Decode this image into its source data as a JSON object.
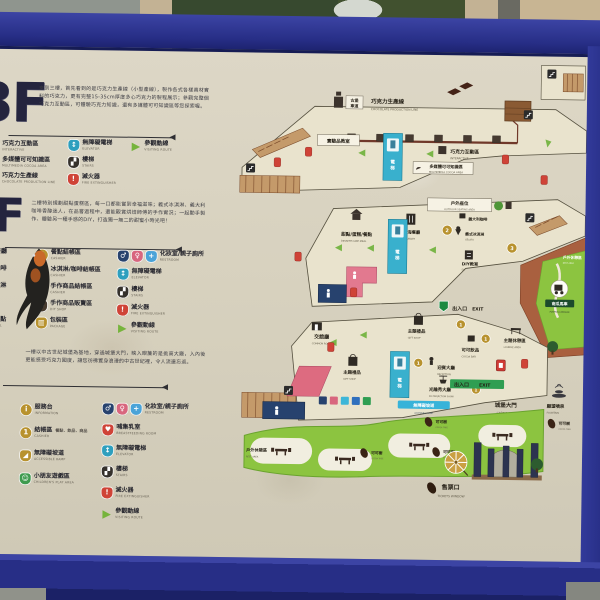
{
  "photo": {
    "scene": "outdoor map signboard of a chocolate castle park",
    "colors": {
      "frame": "#2c3494",
      "sign": "#d8d2c1",
      "lawn": "#8cc440",
      "terrace": "#a9603f",
      "elevator": "#39b0cd",
      "route_arrow": "#7ab648",
      "fire": "#cf4337",
      "restroom_f": "#d8667e",
      "restroom_m": "#27426e",
      "cashier_badge": "#b8922e",
      "exit_green": "#2f9e52"
    }
  },
  "icons": {
    "elevator": "↕",
    "stairs": "▞",
    "fire": "!",
    "route": "▶",
    "info": "i",
    "male": "♂",
    "female": "♀",
    "family": "+",
    "ramp": "◢",
    "shop": "✂",
    "package": "▥",
    "heart": "♥",
    "play": "☺"
  },
  "floors": [
    {
      "big": "3F",
      "intro": "來到三樓，首先看到的是巧克力生產線（小型產線），製作各式各樣真材實料的巧克力，更有完整15-35cm厚度多心巧克力的製程展示；參觀完整個巧克力互動區，可體驗巧克力知識，還有多媒體可可知識區等您探索喔。",
      "legend_left": [
        {
          "zh": "巧克力互動區",
          "en": "INTERACTIVE"
        },
        {
          "zh": "多媒體可可知識區",
          "en": "MULTIMEDIA COCOA AREA"
        },
        {
          "zh": "巧克力生產線",
          "en": "CHOCOLATE PRODUCTION LINE"
        }
      ],
      "legend_mid": [
        {
          "zh": "無障礙電梯",
          "en": "ELEVATOR"
        },
        {
          "zh": "樓梯",
          "en": "STAIRS"
        },
        {
          "zh": "滅火器",
          "en": "FIRE EXTINGUISHER"
        }
      ],
      "legend_right": [
        {
          "zh": "參觀動線",
          "en": "VISITING ROUTE"
        }
      ]
    },
    {
      "big": "2F",
      "intro": "二樓特別規劃甜點蛋糕區，每一口都能嘗到幸福滋味；義式冰淇淋、義大利咖啡香醇迷人，在品嘗過程中，還能觀賞烘焙師傅的手作實況；一起動手製作、體驗另一種手感的DIY，打造獨一無二的甜蜜小時光吧！",
      "legend_left": [
        {
          "zh": "地中海餐廳",
          "en": "RESTAURANT"
        },
        {
          "zh": "義大利咖啡",
          "en": "COFFEE"
        },
        {
          "zh": "義式冰淇淋",
          "en": "GELATO"
        },
        {
          "zh": "DIY教室",
          "en": "DIY ROOM"
        },
        {
          "zh": "甜點/蛋糕/餐點",
          "en": "DESSERT·CAKE·MEAL"
        }
      ],
      "legend_mid": [
        {
          "badge": "1",
          "zh": "餐點結帳區",
          "en": "CASHIER"
        },
        {
          "badge": "2",
          "zh": "冰淇淋/咖啡結帳區",
          "en": "CASHIER"
        },
        {
          "badge": "3",
          "zh": "手作商品結帳區",
          "en": "CASHIER"
        },
        {
          "zh": "手作商品販賣區",
          "en": "DIY SHOP"
        },
        {
          "zh": "包裝區",
          "en": "PACKAGE"
        }
      ],
      "legend_right": [
        {
          "zh": "化妝室/親子廁所",
          "en": "RESTROOM"
        },
        {
          "zh": "無障礙電梯",
          "en": "ELEVATOR"
        },
        {
          "zh": "樓梯",
          "en": "STAIRS"
        },
        {
          "zh": "滅火器",
          "en": "FIRE EXTINGUISHER"
        },
        {
          "zh": "參觀動線",
          "en": "VISITING ROUTE"
        }
      ]
    },
    {
      "big": "1F",
      "intro": "一樓以中古世紀城堡為基地，穿過城堡大門，映入眼簾的是挑高大廳，入內後更能感受巧克力國度，讓您彷彿置身浪漫的中古世紀裡，令人流連忘返。",
      "legend_left": [
        {
          "zh": "服務台",
          "en": "INFORMATION"
        },
        {
          "zh": "結帳區",
          "en": "CASHIER",
          "note": "餐點．飲品．商品"
        },
        {
          "zh": "無障礙坡道",
          "en": "ACCESSIBLE RAMP"
        },
        {
          "zh": "小朋友遊戲區",
          "en": "CHILDREN'S PLAY AREA"
        }
      ],
      "legend_right": [
        {
          "zh": "化妝室/親子廁所",
          "en": "RESTROOM"
        },
        {
          "zh": "哺集乳室",
          "en": "BREASTFEEDING ROOM"
        },
        {
          "zh": "無障礙電梯",
          "en": "ELEVATOR"
        },
        {
          "zh": "樓梯",
          "en": "STAIRS"
        },
        {
          "zh": "滅火器",
          "en": "FIRE EXTINGUISHER"
        },
        {
          "zh": "參觀動線",
          "en": "VISITING ROUTE"
        }
      ]
    }
  ],
  "map": {
    "prod_tag": {
      "c1": "古堡",
      "c2": "車道"
    },
    "prodline": {
      "zh": "巧克力生產線",
      "en": "CHOCOLATE PRODUCTION LINE"
    },
    "lab": {
      "zh": "實驗品教室"
    },
    "interactive": {
      "zh": "巧克力互動區",
      "en": "INTERACTIVE"
    },
    "multimedia": {
      "zh": "多媒體可可知識區",
      "en": "MULTIMEDIA COCOA AREA"
    },
    "elevator": {
      "c1": "電",
      "c2": "梯"
    },
    "outdoor_seating": {
      "zh": "戶外座位",
      "en": "OUTDOOR SEATING AREA"
    },
    "dessert": {
      "zh": "甜點/蛋糕/餐點",
      "en": "DESSERT·CAKE·MEAL"
    },
    "restaurant": {
      "zh": "地中海餐廳",
      "en": "RESTAURANT"
    },
    "coffee": {
      "zh": "義大利咖啡"
    },
    "gelato": {
      "zh": "義式冰淇淋",
      "en": "GELATO"
    },
    "diy": {
      "zh": "DIY教室",
      "en": "DIY"
    },
    "exit": {
      "zh": "出入口",
      "en": "EXIT"
    },
    "pumpkin": {
      "zh": "南瓜馬車",
      "en": "PUMPKIN CARRIAGE"
    },
    "outdoor_rest": {
      "zh": "戶外休憩區",
      "en": "REST AREA"
    },
    "common_room": {
      "zh": "交誼廳",
      "en": "COMMON ROOM"
    },
    "gift": {
      "zh": "主題禮品",
      "en": "GIFT SHOP"
    },
    "cocoa_bar": {
      "zh": "可可飲品",
      "en": "COCOA BAR"
    },
    "lounge": {
      "zh": "主題休憩區",
      "en": "LOUNGE AREA"
    },
    "reception": {
      "zh": "迎賓大廳",
      "en": "RECEPTION"
    },
    "projection": {
      "zh": "光雕秀大廳",
      "en": "3D PROJECTION SHOW"
    },
    "castle_gate": {
      "zh": "城堡大門",
      "en": "CASTLE GATE"
    },
    "fountain": {
      "zh": "願望噴泉",
      "en": "FOUNTAIN"
    },
    "cocoa_tree": {
      "zh": "可可樹",
      "en": "COCOA TREE"
    },
    "ramp": {
      "zh": "無障礙坡道",
      "en": "ACCESSIBLE RAMP"
    },
    "tickets": {
      "zh": "售票口",
      "en": "TICKETS WINDOW"
    },
    "badge": {
      "b1": "1",
      "b2": "2",
      "b3": "3"
    }
  }
}
